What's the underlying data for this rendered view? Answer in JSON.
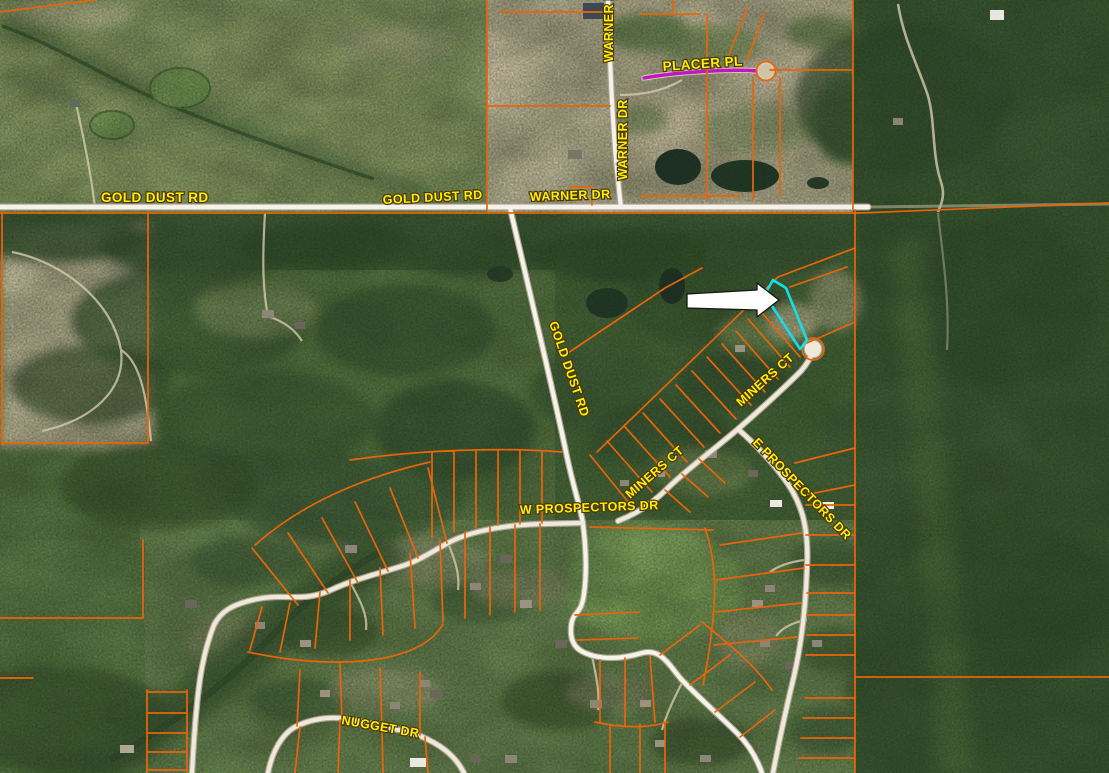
{
  "app": {
    "name": "parcel-map-viewer",
    "view": "satellite-imagery-with-parcels"
  },
  "map": {
    "road_labels": [
      {
        "id": "gold-dust-rd-west",
        "text": "GOLD DUST RD"
      },
      {
        "id": "gold-dust-rd-mid",
        "text": "GOLD DUST RD"
      },
      {
        "id": "warner-dr-horiz",
        "text": "WARNER DR"
      },
      {
        "id": "warner-dr-top",
        "text": "WARNER DR"
      },
      {
        "id": "warner-dr-vert",
        "text": "WARNER DR"
      },
      {
        "id": "placer-pl",
        "text": "PLACER PL"
      },
      {
        "id": "gold-dust-rd-south",
        "text": "GOLD DUST RD"
      },
      {
        "id": "miners-ct-upper",
        "text": "MINERS CT"
      },
      {
        "id": "miners-ct-lower",
        "text": "MINERS CT"
      },
      {
        "id": "e-prospectors-dr",
        "text": "E PROSPECTORS DR"
      },
      {
        "id": "w-prospectors-dr",
        "text": "W PROSPECTORS DR"
      },
      {
        "id": "nugget-dr",
        "text": "NUGGET DR"
      }
    ],
    "selected_parcel": {
      "outline_color": "#14dfe6"
    },
    "pointer_arrow": {
      "fill": "#ffffff",
      "outline": "#161616",
      "direction": "right"
    },
    "colors": {
      "parcel_line": "#e8650a",
      "road": "#f5f2ea",
      "road_casing": "#aba28f",
      "placer_road": "#c116c1",
      "label_text": "#ffee00",
      "label_halo": "#4a3800"
    }
  }
}
